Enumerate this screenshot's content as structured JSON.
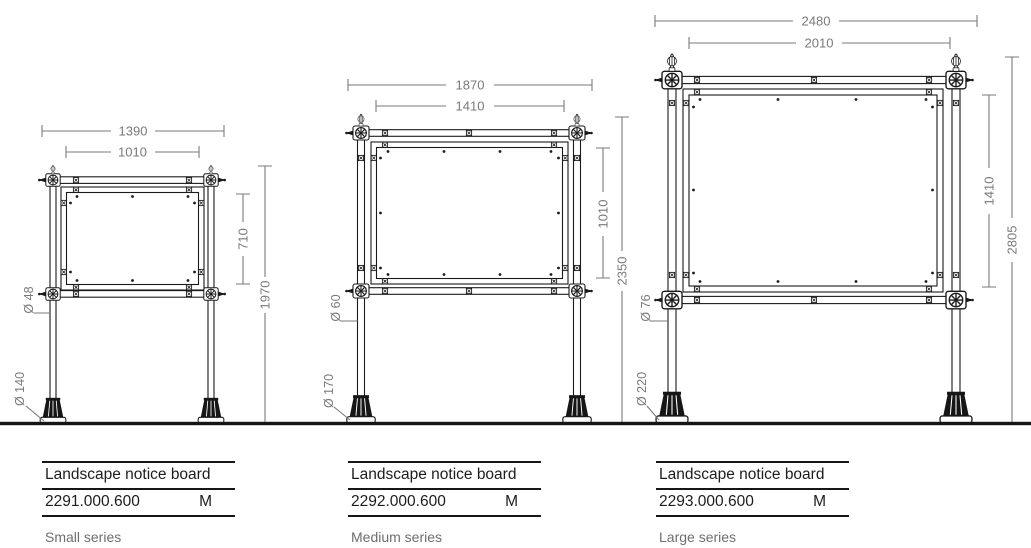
{
  "boards": [
    {
      "series_label": "Small series",
      "table": {
        "product_name": "Landscape notice board",
        "article_number": "2291.000.600",
        "model_code": "M"
      },
      "dimensions": {
        "overall_width_mm": "1390",
        "board_width_mm": "1010",
        "board_height_mm": "710",
        "overall_height_mm": "1970",
        "post_diameter": "Ø 48",
        "foot_diameter": "Ø 140"
      }
    },
    {
      "series_label": "Medium series",
      "table": {
        "product_name": "Landscape notice board",
        "article_number": "2292.000.600",
        "model_code": "M"
      },
      "dimensions": {
        "overall_width_mm": "1870",
        "board_width_mm": "1410",
        "board_height_mm": "1010",
        "overall_height_mm": "2350",
        "post_diameter": "Ø 60",
        "foot_diameter": "Ø 170"
      }
    },
    {
      "series_label": "Large series",
      "table": {
        "product_name": "Landscape notice board",
        "article_number": "2293.000.600",
        "model_code": "M"
      },
      "dimensions": {
        "overall_width_mm": "2480",
        "board_width_mm": "2010",
        "board_height_mm": "1410",
        "overall_height_mm": "2805",
        "post_diameter": "Ø 76",
        "foot_diameter": "Ø 220"
      }
    }
  ],
  "colors": {
    "drawing_line": "#1a1a1a",
    "dimension": "#7a7a7a",
    "ground": "#151515",
    "table_text": "#1d1d1d",
    "series_text": "#6e6e6e"
  }
}
